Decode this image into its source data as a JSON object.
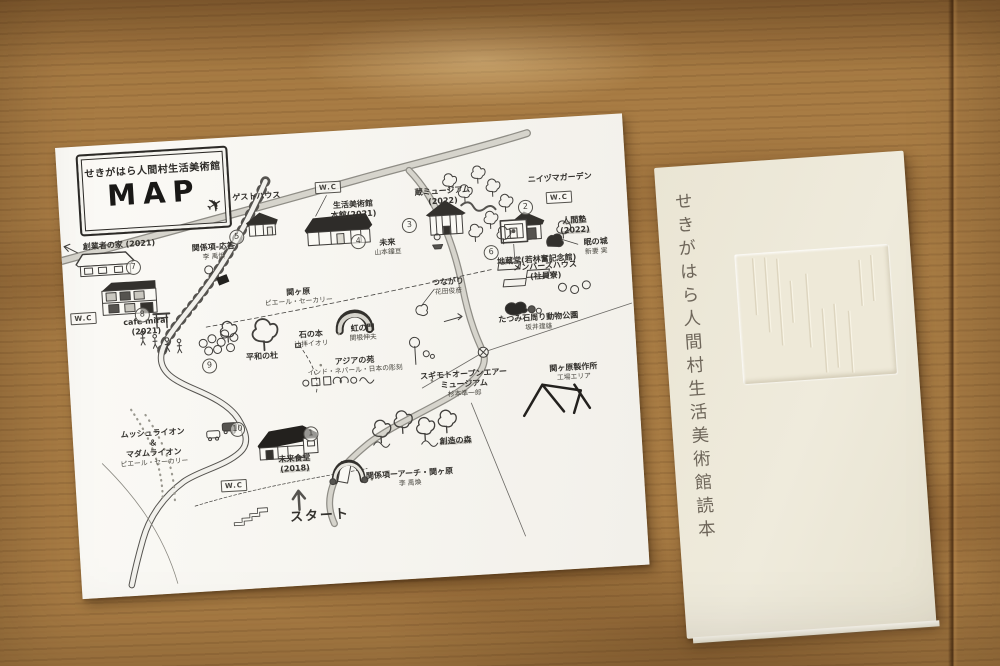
{
  "map": {
    "title": "せきがはら人間村生活美術館",
    "map_word": "MAP",
    "plane_icon": "✈",
    "wc": "W.C",
    "circles": [
      "1",
      "2",
      "3",
      "4",
      "5",
      "6",
      "7",
      "8",
      "9",
      "10"
    ],
    "labels": [
      {
        "main": "ゲストハウス"
      },
      {
        "main": "生活美術館\n本館(2021)"
      },
      {
        "main": "蔵ミュージアム\n(2022)"
      },
      {
        "main": "ニイヅマガーデン"
      },
      {
        "main": "人間塾\n(2022)"
      },
      {
        "main": "眠の城",
        "sub": "新妻 実"
      },
      {
        "main": "未来",
        "sub": "山本鐘亘"
      },
      {
        "main": "創業者の家 (2021)"
      },
      {
        "main": "関係項-応答",
        "sub": "李 禹煥"
      },
      {
        "main": "地蔵堂(若林奮記念館)"
      },
      {
        "main": "cafe mirai\n(2021)"
      },
      {
        "main": "関ヶ原",
        "sub": "ピエール・セーカリー"
      },
      {
        "main": "平和の杜"
      },
      {
        "main": "石の本",
        "sub": "辻拝イオリ"
      },
      {
        "main": "虹の門",
        "sub": "関根伸夫"
      },
      {
        "main": "つながり",
        "sub": "花田俊彦"
      },
      {
        "main": "メンバーズハウス\n(社員寮)"
      },
      {
        "main": "たつみ石周り動物公園",
        "sub": "坂井建雄"
      },
      {
        "main": "アジアの苑",
        "sub": "インド・ネパール・日本の彫刻"
      },
      {
        "main": "スギモトオープンエアー\nミュージアム",
        "sub": "杉本準一郎"
      },
      {
        "main": "関ヶ原製作所",
        "sub": "工場エリア"
      },
      {
        "main": "ムッシュライオン\n＆\nマダムライオン",
        "sub": "ピエール・セーカリー"
      },
      {
        "main": "未来食堂\n(2018)"
      },
      {
        "main": "関係項ーアーチ・関ヶ原",
        "sub": "李 禹煥"
      },
      {
        "main": "創造の森"
      },
      {
        "main": "スタート"
      }
    ]
  },
  "booklet": {
    "title": "せきがはら人間村生活美術館読本"
  }
}
